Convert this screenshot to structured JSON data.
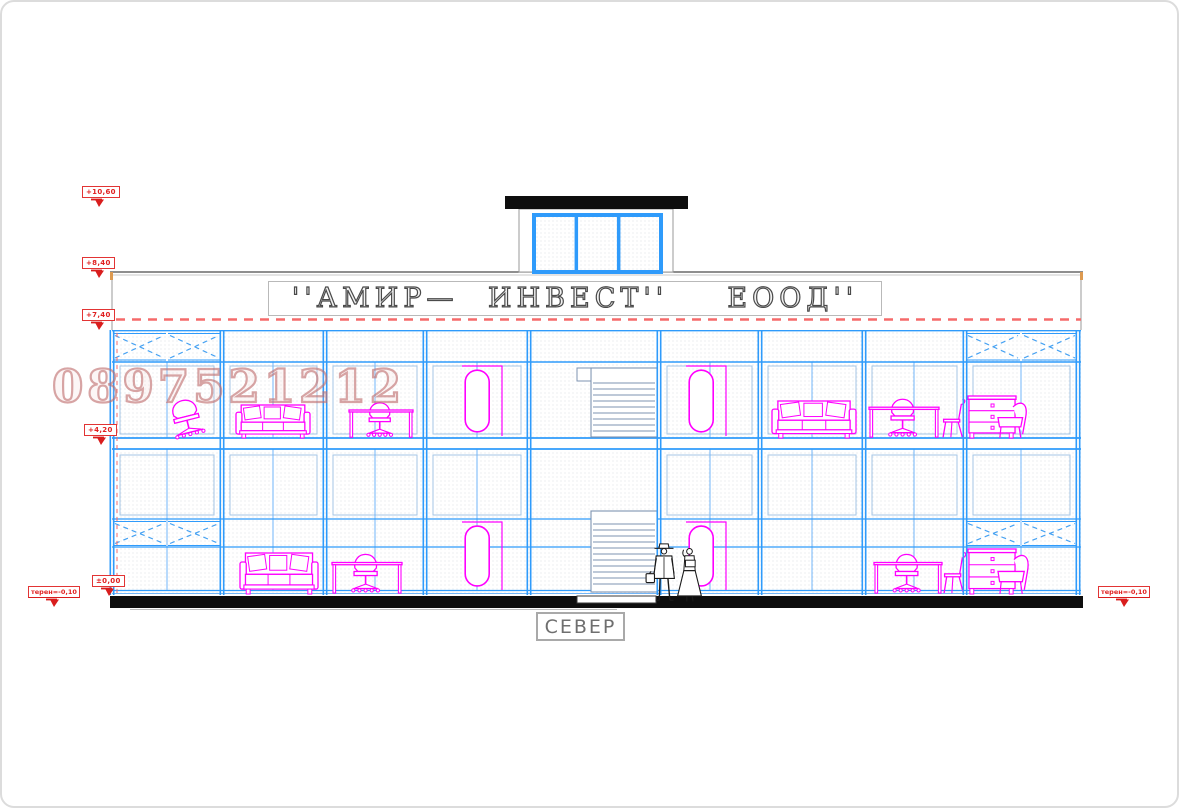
{
  "sign": {
    "text": "''АМИР— ИНВЕСТ''  ЕООД''"
  },
  "direction_label": "СЕВЕР",
  "watermark": "0897521212",
  "colors": {
    "mullion_blue": "#2f9bfb",
    "light_blue": "#72b6f8",
    "pane_outline": "#a4c6e6",
    "magenta": "#ff00ff",
    "marker_red": "#e01f1f",
    "dash_salmon": "#f56a6a",
    "stair_steel": "#7d93b0",
    "ink_black": "#0e0e0e",
    "edge_gray": "#9a9a9a",
    "corner_orange": "#dd9a50"
  },
  "elevation_markers": [
    {
      "label": "+10,60",
      "x": 82,
      "y": 186
    },
    {
      "label": "+8,40",
      "x": 82,
      "y": 257
    },
    {
      "label": "+7,40",
      "x": 82,
      "y": 309
    },
    {
      "label": "+4,20",
      "x": 84,
      "y": 424
    },
    {
      "label": "±0,00",
      "x": 92,
      "y": 575
    }
  ],
  "terrain_markers": [
    {
      "label": "терен=-0,10",
      "x": 28,
      "y": 586
    },
    {
      "label": "терен=-0,10",
      "x": 1098,
      "y": 586
    }
  ],
  "facade": {
    "left": 112,
    "right": 1081,
    "roof_line_y": 272,
    "band_bottom_y": 330,
    "dashed_line_y": 319,
    "wall_top": 330,
    "wall_bottom": 596,
    "transom_y": 362,
    "slab_top": 438,
    "slab_bottom": 449,
    "ground_band_top": 519,
    "ground_band_bottom": 547,
    "bottom_line1": 590,
    "bottom_line2": 593,
    "major_mullions": [
      112,
      222,
      325,
      425,
      529,
      659,
      760,
      864,
      965,
      1078
    ],
    "sub_mullions": [
      167,
      273,
      375,
      477,
      710,
      812,
      914,
      1021
    ],
    "x_panels_upper": [
      [
        112,
        167
      ],
      [
        167,
        222
      ],
      [
        965,
        1021
      ],
      [
        1021,
        1078
      ]
    ],
    "x_panels_ground": [
      [
        112,
        167
      ],
      [
        167,
        222
      ],
      [
        965,
        1021
      ],
      [
        1021,
        1078
      ]
    ],
    "red_dash_vertical_x": 117,
    "plinth": {
      "x": 110,
      "y": 596,
      "w": 973,
      "h": 12
    },
    "entry_notch": {
      "x": 577,
      "y": 596,
      "w": 79,
      "h": 7
    }
  },
  "rooftop": {
    "slab": {
      "x": 505,
      "y": 196,
      "w": 183,
      "h": 13
    },
    "wall": {
      "x": 519,
      "y": 209,
      "w": 154,
      "h": 63
    },
    "window": {
      "x": 534,
      "y": 215,
      "w": 127,
      "h": 57
    },
    "panes": 3
  },
  "stairs": {
    "upper": {
      "x": 591,
      "w": 66,
      "top": 368,
      "bottom": 437,
      "landing": [
        577,
        368,
        14,
        13
      ],
      "step_start": 383,
      "step_gap": 6
    },
    "ground": {
      "x": 591,
      "w": 66,
      "top": 511,
      "bottom": 592,
      "step_start": 524,
      "step_gap": 6
    }
  },
  "furniture": [
    {
      "type": "office-chair",
      "x": 166,
      "y": 395,
      "w": 40,
      "h": 43
    },
    {
      "type": "sofa",
      "x": 236,
      "y": 405,
      "w": 74,
      "h": 33
    },
    {
      "type": "desk",
      "x": 349,
      "y": 398,
      "w": 64,
      "h": 40
    },
    {
      "type": "stadium",
      "x": 462,
      "y": 366,
      "w": 40,
      "h": 70
    },
    {
      "type": "stadium",
      "x": 686,
      "y": 366,
      "w": 40,
      "h": 70
    },
    {
      "type": "sofa",
      "x": 772,
      "y": 401,
      "w": 84,
      "h": 37
    },
    {
      "type": "desk",
      "x": 869,
      "y": 394,
      "w": 70,
      "h": 44
    },
    {
      "type": "chair",
      "x": 941,
      "y": 399,
      "w": 26,
      "h": 39
    },
    {
      "type": "drawers",
      "x": 968,
      "y": 396,
      "w": 48,
      "h": 42
    },
    {
      "type": "armchair",
      "x": 998,
      "y": 401,
      "w": 30,
      "h": 37
    },
    {
      "type": "sofa",
      "x": 240,
      "y": 553,
      "w": 78,
      "h": 41
    },
    {
      "type": "desk",
      "x": 332,
      "y": 549,
      "w": 70,
      "h": 45
    },
    {
      "type": "stadium",
      "x": 462,
      "y": 522,
      "w": 40,
      "h": 68
    },
    {
      "type": "stadium",
      "x": 686,
      "y": 522,
      "w": 40,
      "h": 68
    },
    {
      "type": "desk",
      "x": 874,
      "y": 549,
      "w": 68,
      "h": 45
    },
    {
      "type": "chair",
      "x": 942,
      "y": 552,
      "w": 26,
      "h": 42
    },
    {
      "type": "drawers",
      "x": 968,
      "y": 549,
      "w": 48,
      "h": 45
    },
    {
      "type": "armchair",
      "x": 998,
      "y": 553,
      "w": 32,
      "h": 41
    }
  ],
  "people": [
    {
      "type": "man",
      "x": 650,
      "y": 543,
      "w": 28,
      "h": 59
    },
    {
      "type": "woman",
      "x": 676,
      "y": 547,
      "w": 27,
      "h": 55
    }
  ]
}
